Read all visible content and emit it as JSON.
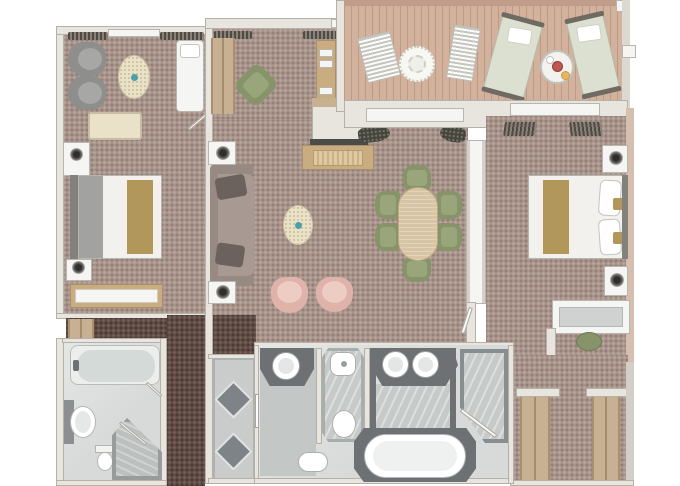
{
  "scene": {
    "type": "floor-plan",
    "description": "Top-down rendered floor plan of a two-bedroom suite with veranda",
    "rooms": [
      "sitting-area",
      "bedroom-1",
      "bathroom-1",
      "entry-foyer",
      "living-dining-room",
      "veranda",
      "bedroom-2",
      "master-bathroom",
      "shower-room",
      "dressing-area",
      "corridor"
    ],
    "furniture": [
      "armchair",
      "oval-rug-table",
      "chaise",
      "bench",
      "double-bed",
      "nightstand",
      "lamp",
      "dresser",
      "bathtub",
      "sink",
      "toilet",
      "corner-shower",
      "sofa",
      "side-table",
      "coffee-table",
      "tub-chair",
      "sideboard-tv",
      "dining-table",
      "dining-chair",
      "console",
      "deck-lounger",
      "deck-chair",
      "deck-table",
      "round-mat",
      "desk",
      "stool",
      "wardrobe-closet",
      "double-vanity",
      "bidet"
    ]
  },
  "colors": {
    "carpet": "#a8938a",
    "carpetDark": "#5f4b43",
    "deck": "#d2b19d",
    "deckEdge": "#c09d8a",
    "wall": "#e8e5df",
    "wallEdge": "#b5b0a8",
    "bath": "#d7dad8",
    "marble": "#c6cac8",
    "counter": "#6d7173",
    "diamond": "#7d8386",
    "white": "#f5f5f3",
    "cream": "#eae2c8",
    "wood": "#c9ad80",
    "woodLight": "#dfc9a0",
    "tableWood": "#d8c5a6",
    "green": "#87946a",
    "greenLight": "#99a67c",
    "pink": "#dfb2aa",
    "pinkLight": "#edcdc3",
    "sofa": "#a89a92",
    "sofaBack": "#968a82",
    "pillow": "#6b625d",
    "grayChair": "#8e8e8c",
    "grayChairLight": "#a7a7a5",
    "gold": "#b2975a",
    "bed": "#f2f1ee",
    "bedFold": "#a2a2a0",
    "headboard": "#83817d",
    "tan": "#c8b193",
    "teal": "#4aa0a8",
    "red": "#c0574e",
    "lounger": "#dce0d0",
    "extWall": "#d6bfb0",
    "plant": "#45453c",
    "tubInner": "#eef1ef"
  }
}
